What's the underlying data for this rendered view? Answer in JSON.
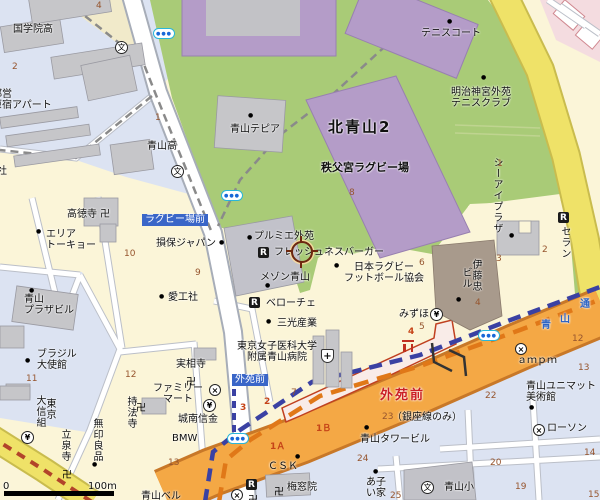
{
  "map": {
    "region_name": "北青山2",
    "station_name": "外苑前",
    "colors": {
      "land": "#FBF5D8",
      "ward_other": "#DCE3F2",
      "park": "#A9CB77",
      "stadium": "#B49CC8",
      "road_major": "#F4A845",
      "road_yellow": "#EFE268",
      "subway_ginza": "#3A41A3",
      "subway_hanzomon": "#E07818",
      "station_name_color": "#CB1F24",
      "busstop_bg": "#3A66C8",
      "block_number": "#96552E",
      "building": "#C6C6C9",
      "platform": "#F9ECE8"
    },
    "scale": {
      "start": "0",
      "end": "100m"
    },
    "cursor": {
      "x": 302,
      "y": 252
    },
    "icon_glyphs": {
      "school": "文",
      "restaurant": "R",
      "bank": "¥",
      "convenience": "×",
      "hospital": "+",
      "temple": "卍",
      "subway-entrance": "●●●",
      "torii": ""
    },
    "labels": [
      {
        "name": "kokugakuin-high-label",
        "text": "国学院高",
        "x": 13,
        "y": 24
      },
      {
        "name": "toei-harajuku-apartment-label",
        "text": "都営\n原宿アパート",
        "x": -8,
        "y": 89
      },
      {
        "name": "aoyama-high-label",
        "text": "青山高",
        "x": 147,
        "y": 141
      },
      {
        "name": "partial-company-label",
        "text": "社",
        "x": -3,
        "y": 166
      },
      {
        "name": "aoyama-tepia-label",
        "text": "青山テピア",
        "x": 230,
        "y": 124
      },
      {
        "name": "kita-aoyama-2-label",
        "text": "北青山2",
        "x": 328,
        "y": 119,
        "cls": "big"
      },
      {
        "name": "tennis-court-label",
        "text": "テニスコート",
        "x": 421,
        "y": 28
      },
      {
        "name": "meiji-jingu-gaien-tennis-club-label",
        "text": "明治神宮外苑\nテニスクラブ",
        "x": 451,
        "y": 87,
        "cls": "tc"
      },
      {
        "name": "chichibunomiya-rugby-stadium-label",
        "text": "秩父宮ラグビー場",
        "x": 321,
        "y": 162,
        "cls": "mid"
      },
      {
        "name": "rugby-jo-mae-stop-label",
        "text": "ラグビー場前",
        "x": 142,
        "y": 214,
        "cls": "busstop"
      },
      {
        "name": "sompo-japan-label",
        "text": "損保ジャパン",
        "x": 156,
        "y": 238
      },
      {
        "name": "aikosha-label",
        "text": "愛工社",
        "x": 168,
        "y": 292
      },
      {
        "name": "area-tokyo-label",
        "text": "エリア\nトーキョー",
        "x": 46,
        "y": 229
      },
      {
        "name": "kotokuji-temple-label",
        "text": "高徳寺 卍",
        "x": 67,
        "y": 209
      },
      {
        "name": "premier-gaien-label",
        "text": "プルミエ外苑",
        "x": 254,
        "y": 231
      },
      {
        "name": "freshness-burger-label",
        "text": "フレッシュネスバーガー",
        "x": 274,
        "y": 247
      },
      {
        "name": "maison-aoyama-label",
        "text": "メゾン青山",
        "x": 260,
        "y": 272
      },
      {
        "name": "japan-rugby-football-union-label",
        "text": "日本ラグビー\nフットボール協会",
        "x": 344,
        "y": 262,
        "cls": "tc"
      },
      {
        "name": "veloce-cafe-label",
        "text": "ベローチェ",
        "x": 266,
        "y": 298
      },
      {
        "name": "sanko-sangyo-label",
        "text": "三光産業",
        "x": 277,
        "y": 318
      },
      {
        "name": "tokyo-womens-medical-univ-hospital-label",
        "text": "東京女子医科大学\n附属青山病院",
        "x": 237,
        "y": 341,
        "cls": "tc"
      },
      {
        "name": "gaienmae-stop-label",
        "text": "外苑前",
        "x": 232,
        "y": 374,
        "cls": "busstop"
      },
      {
        "name": "aoyama-plaza-building-label",
        "text": "青山\nプラザビル",
        "x": 24,
        "y": 294
      },
      {
        "name": "brazil-embassy-label",
        "text": "ブラジル\n大使館",
        "x": 37,
        "y": 349
      },
      {
        "name": "jissoji-temple-label",
        "text": "実相寺",
        "x": 176,
        "y": 359
      },
      {
        "name": "family-mart-label",
        "text": "ファミリー\nマート",
        "x": 153,
        "y": 383,
        "cls": "tc"
      },
      {
        "name": "jonan-shinkin-label",
        "text": "城南信金",
        "x": 178,
        "y": 414
      },
      {
        "name": "bmw-label",
        "text": "BMW",
        "x": 172,
        "y": 433
      },
      {
        "name": "mizuho-label",
        "text": "みずほ",
        "x": 399,
        "y": 309
      },
      {
        "name": "gaienmae-station-label",
        "text": "外苑前",
        "x": 380,
        "y": 389,
        "cls": "station"
      },
      {
        "name": "ginza-line-only-label",
        "text": "（銀座線のみ）",
        "x": 392,
        "y": 412
      },
      {
        "name": "aoyama-tower-building-label",
        "text": "青山タワービル",
        "x": 360,
        "y": 434
      },
      {
        "name": "csk-label",
        "text": "ＣＳＫ",
        "x": 268,
        "y": 461
      },
      {
        "name": "baisoin-temple-label",
        "text": "梅窓院",
        "x": 287,
        "y": 482
      },
      {
        "name": "ako-partial-label",
        "text": "あ子\nい家",
        "x": 366,
        "y": 477
      },
      {
        "name": "aoyama-elementary-label",
        "text": "青山小",
        "x": 444,
        "y": 482
      },
      {
        "name": "lawson-label",
        "text": "ローソン",
        "x": 547,
        "y": 423
      },
      {
        "name": "ampm-label",
        "text": "ａｍｐｍ",
        "x": 517,
        "y": 355
      },
      {
        "name": "aoyama-unimat-museum-label",
        "text": "青山ユニマット\n美術館",
        "x": 526,
        "y": 381
      },
      {
        "name": "aoyama-bell-partial-label",
        "text": "青山ベル",
        "x": 141,
        "y": 491
      },
      {
        "name": "road-name-ao-label",
        "text": "青",
        "x": 541,
        "y": 320,
        "cls": "blue"
      },
      {
        "name": "road-name-yama-label",
        "text": "山",
        "x": 560,
        "y": 314,
        "cls": "blue"
      },
      {
        "name": "road-name-dori-label",
        "text": "通",
        "x": 580,
        "y": 299,
        "cls": "blue"
      },
      {
        "name": "scale-zero-label",
        "text": "0",
        "x": 3,
        "y": 481
      },
      {
        "name": "scale-100m-label",
        "text": "100m",
        "x": 88,
        "y": 481
      },
      {
        "name": "ci-plaza-label",
        "text": "シーアイプラザ",
        "x": 491,
        "y": 157,
        "cls": "v"
      },
      {
        "name": "seran-label",
        "text": "セラン",
        "x": 559,
        "y": 226,
        "cls": "v"
      },
      {
        "name": "itochu-building-label-1",
        "text": "伊藤忠",
        "x": 470,
        "y": 259,
        "cls": "v"
      },
      {
        "name": "itochu-building-label-2",
        "text": "ビル",
        "x": 460,
        "y": 267,
        "cls": "v"
      },
      {
        "name": "jihoji-temple-label",
        "text": "持法寺",
        "x": 125,
        "y": 396,
        "cls": "v"
      },
      {
        "name": "ryusenji-temple-label",
        "text": "立泉寺",
        "x": 59,
        "y": 429,
        "cls": "v"
      },
      {
        "name": "muji-label",
        "text": "無印良品",
        "x": 91,
        "y": 418,
        "cls": "v"
      },
      {
        "name": "dai-tokyo-shinkumi-label-1",
        "text": "大信組",
        "x": 34,
        "y": 395,
        "cls": "v"
      },
      {
        "name": "dai-tokyo-shinkumi-label-2",
        "text": "東京",
        "x": 44,
        "y": 398,
        "cls": "v"
      },
      {
        "name": "block-number",
        "text": "4",
        "x": 96,
        "y": 2,
        "cls": "num"
      },
      {
        "name": "block-number",
        "text": "2",
        "x": 12,
        "y": 63,
        "cls": "num"
      },
      {
        "name": "block-number",
        "text": "1",
        "x": 155,
        "y": 114,
        "cls": "num"
      },
      {
        "name": "block-number",
        "text": "8",
        "x": 349,
        "y": 189,
        "cls": "num"
      },
      {
        "name": "block-number",
        "text": "1",
        "x": 497,
        "y": 160,
        "cls": "num"
      },
      {
        "name": "block-number",
        "text": "10",
        "x": 124,
        "y": 250,
        "cls": "num"
      },
      {
        "name": "block-number",
        "text": "9",
        "x": 195,
        "y": 269,
        "cls": "num"
      },
      {
        "name": "block-number",
        "text": "6",
        "x": 419,
        "y": 259,
        "cls": "num"
      },
      {
        "name": "block-number",
        "text": "3",
        "x": 496,
        "y": 255,
        "cls": "num"
      },
      {
        "name": "block-number",
        "text": "2",
        "x": 542,
        "y": 246,
        "cls": "num"
      },
      {
        "name": "block-number",
        "text": "4",
        "x": 475,
        "y": 299,
        "cls": "num"
      },
      {
        "name": "block-number",
        "text": "5",
        "x": 419,
        "y": 323,
        "cls": "num"
      },
      {
        "name": "block-number",
        "text": "11",
        "x": 26,
        "y": 375,
        "cls": "num"
      },
      {
        "name": "block-number",
        "text": "12",
        "x": 125,
        "y": 371,
        "cls": "num"
      },
      {
        "name": "block-number",
        "text": "7",
        "x": 291,
        "y": 389,
        "cls": "num"
      },
      {
        "name": "block-number",
        "text": "23",
        "x": 382,
        "y": 413,
        "cls": "num"
      },
      {
        "name": "block-number",
        "text": "24",
        "x": 357,
        "y": 455,
        "cls": "num"
      },
      {
        "name": "block-number",
        "text": "25",
        "x": 390,
        "y": 492,
        "cls": "num"
      },
      {
        "name": "block-number",
        "text": "22",
        "x": 485,
        "y": 392,
        "cls": "num"
      },
      {
        "name": "block-number",
        "text": "12",
        "x": 572,
        "y": 335,
        "cls": "num"
      },
      {
        "name": "block-number",
        "text": "13",
        "x": 578,
        "y": 364,
        "cls": "num"
      },
      {
        "name": "block-number",
        "text": "14",
        "x": 584,
        "y": 449,
        "cls": "num"
      },
      {
        "name": "block-number",
        "text": "15",
        "x": 588,
        "y": 491,
        "cls": "num"
      },
      {
        "name": "block-number",
        "text": "20",
        "x": 490,
        "y": 459,
        "cls": "num"
      },
      {
        "name": "block-number",
        "text": "19",
        "x": 515,
        "y": 483,
        "cls": "num"
      },
      {
        "name": "block-number",
        "text": "13",
        "x": 168,
        "y": 459,
        "cls": "num"
      },
      {
        "name": "block-number",
        "text": "4",
        "x": 408,
        "y": 328,
        "cls": "numr"
      },
      {
        "name": "block-number",
        "text": "3",
        "x": 240,
        "y": 404,
        "cls": "numr"
      },
      {
        "name": "block-number",
        "text": "2",
        "x": 264,
        "y": 398,
        "cls": "numr"
      },
      {
        "name": "exit-1a-label",
        "text": "1Ａ",
        "x": 270,
        "y": 443,
        "cls": "numr"
      },
      {
        "name": "exit-1b-label",
        "text": "1Ｂ",
        "x": 316,
        "y": 425,
        "cls": "numr"
      },
      {
        "name": "poi-dot",
        "text": "●",
        "x": 248,
        "y": 113,
        "cls": "dot"
      },
      {
        "name": "poi-dot",
        "text": "●",
        "x": 447,
        "y": 19,
        "cls": "dot"
      },
      {
        "name": "poi-dot",
        "text": "●",
        "x": 481,
        "y": 75,
        "cls": "dot"
      },
      {
        "name": "poi-dot",
        "text": "●",
        "x": 36,
        "y": 229,
        "cls": "dot"
      },
      {
        "name": "poi-dot",
        "text": "●",
        "x": 219,
        "y": 240,
        "cls": "dot"
      },
      {
        "name": "poi-dot",
        "text": "●",
        "x": 159,
        "y": 294,
        "cls": "dot"
      },
      {
        "name": "poi-dot",
        "text": "●",
        "x": 247,
        "y": 235,
        "cls": "dot"
      },
      {
        "name": "poi-dot",
        "text": "●",
        "x": 265,
        "y": 283,
        "cls": "dot"
      },
      {
        "name": "poi-dot",
        "text": "●",
        "x": 334,
        "y": 263,
        "cls": "dot"
      },
      {
        "name": "poi-dot",
        "text": "●",
        "x": 266,
        "y": 319,
        "cls": "dot"
      },
      {
        "name": "poi-dot",
        "text": "●",
        "x": 29,
        "y": 288,
        "cls": "dot"
      },
      {
        "name": "poi-dot",
        "text": "●",
        "x": 25,
        "y": 358,
        "cls": "dot"
      },
      {
        "name": "poi-dot",
        "text": "●",
        "x": 509,
        "y": 233,
        "cls": "dot"
      },
      {
        "name": "poi-dot",
        "text": "●",
        "x": 456,
        "y": 297,
        "cls": "dot"
      },
      {
        "name": "poi-dot",
        "text": "●",
        "x": 92,
        "y": 462,
        "cls": "dot"
      },
      {
        "name": "poi-dot",
        "text": "●",
        "x": 295,
        "y": 454,
        "cls": "dot"
      },
      {
        "name": "poi-dot",
        "text": "●",
        "x": 373,
        "y": 469,
        "cls": "dot"
      },
      {
        "name": "poi-dot",
        "text": "●",
        "x": 364,
        "y": 425,
        "cls": "dot"
      },
      {
        "name": "poi-dot",
        "text": "●",
        "x": 529,
        "y": 405,
        "cls": "dot"
      }
    ],
    "icons": [
      {
        "type": "school",
        "x": 115,
        "y": 41
      },
      {
        "type": "school",
        "x": 171,
        "y": 165
      },
      {
        "type": "school",
        "x": 421,
        "y": 481
      },
      {
        "type": "restaurant",
        "x": 258,
        "y": 247
      },
      {
        "type": "restaurant",
        "x": 249,
        "y": 297
      },
      {
        "type": "restaurant",
        "x": 558,
        "y": 212
      },
      {
        "type": "restaurant",
        "x": 246,
        "y": 479
      },
      {
        "type": "bank",
        "x": 430,
        "y": 308
      },
      {
        "type": "bank",
        "x": 203,
        "y": 399
      },
      {
        "type": "bank",
        "x": 21,
        "y": 431
      },
      {
        "type": "convenience",
        "x": 209,
        "y": 384
      },
      {
        "type": "convenience",
        "x": 515,
        "y": 343
      },
      {
        "type": "convenience",
        "x": 533,
        "y": 424
      },
      {
        "type": "convenience",
        "x": 231,
        "y": 489
      },
      {
        "type": "hospital",
        "x": 321,
        "y": 349
      },
      {
        "type": "subway-entrance",
        "x": 153,
        "y": 28
      },
      {
        "type": "subway-entrance",
        "x": 221,
        "y": 190
      },
      {
        "type": "subway-entrance",
        "x": 227,
        "y": 433
      },
      {
        "type": "subway-entrance",
        "x": 478,
        "y": 330
      },
      {
        "type": "temple",
        "x": 186,
        "y": 373
      },
      {
        "type": "temple",
        "x": 136,
        "y": 399
      },
      {
        "type": "temple",
        "x": 274,
        "y": 483
      },
      {
        "type": "temple",
        "x": 62,
        "y": 466
      },
      {
        "type": "temple",
        "x": 248,
        "y": 491
      },
      {
        "type": "torii",
        "x": 402,
        "y": 340
      }
    ]
  }
}
